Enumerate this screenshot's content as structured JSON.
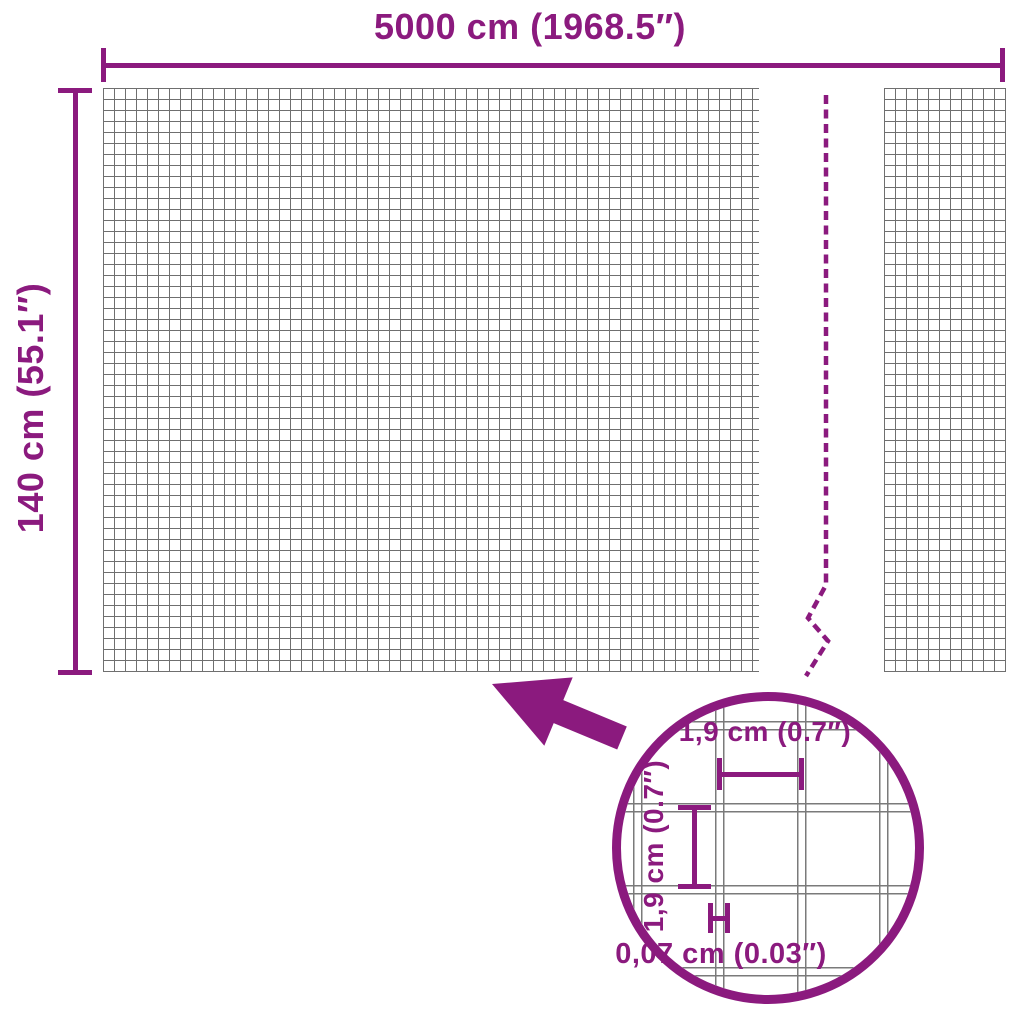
{
  "diagram": {
    "width_dimension": {
      "label": "5000 cm (1968.5″)"
    },
    "height_dimension": {
      "label": "140 cm (55.1″)"
    },
    "detail": {
      "cell_width": {
        "label": "1,9 cm (0.7″)"
      },
      "cell_height": {
        "label": "1,9 cm (0.7″)"
      },
      "wire_thickness": {
        "label": "0,07 cm (0.03″)"
      }
    }
  },
  "colors": {
    "accent": "#8B1A7E",
    "mesh-line": "#6F6F6F",
    "wire-line": "#7A7A7A",
    "background": "#FFFFFF"
  }
}
